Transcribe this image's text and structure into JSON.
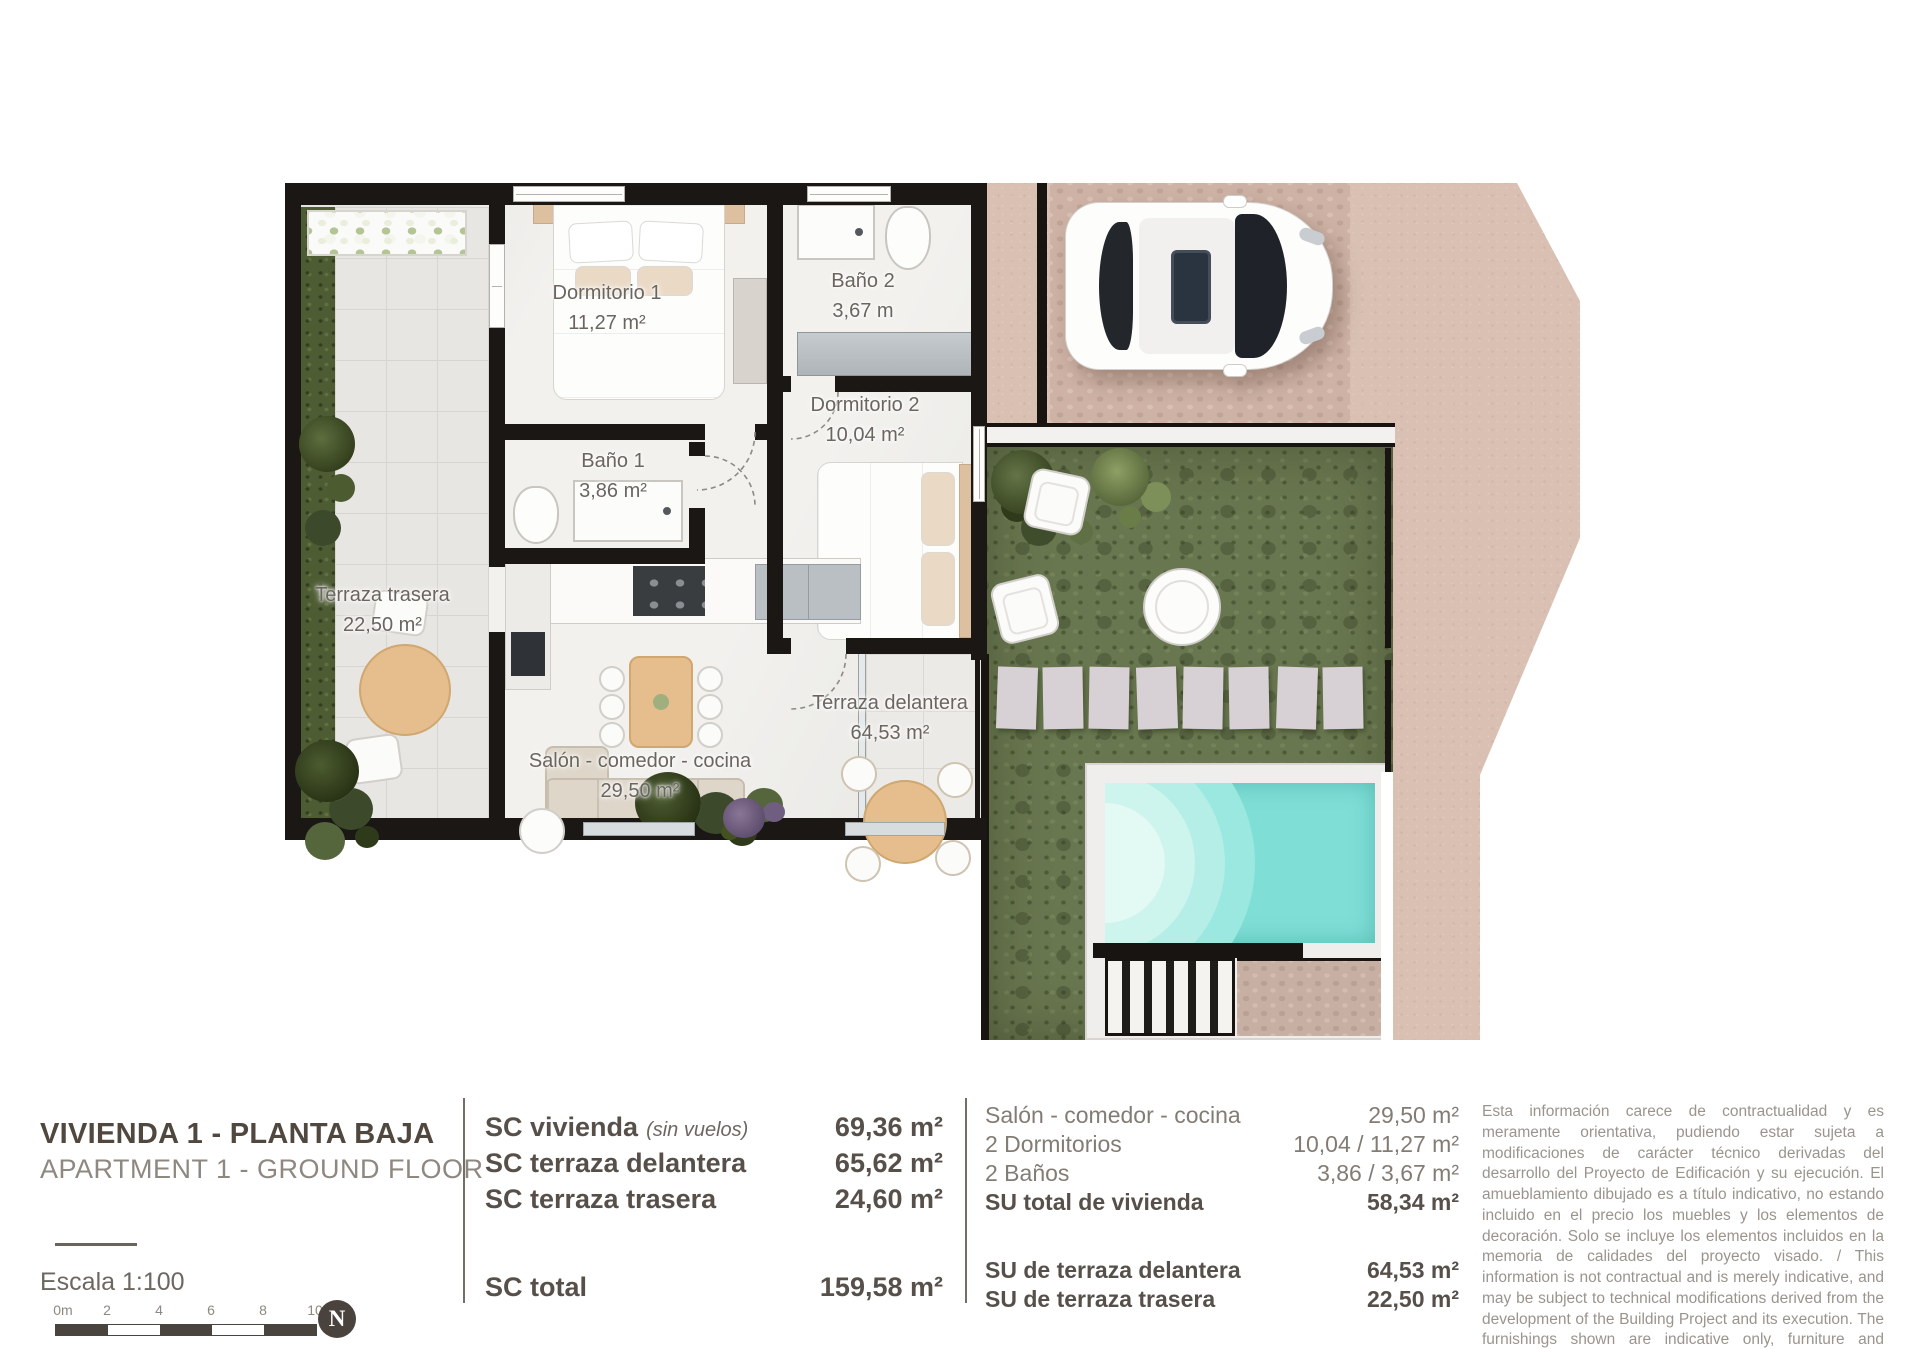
{
  "plan": {
    "rooms": [
      {
        "name": "Dormitorio 1",
        "area": "11,27 m²"
      },
      {
        "name": "Baño 2",
        "area": "3,67 m"
      },
      {
        "name": "Baño 1",
        "area": "3,86 m²"
      },
      {
        "name": "Dormitorio 2",
        "area": "10,04 m²"
      },
      {
        "name": "Terraza trasera",
        "area": "22,50 m²"
      },
      {
        "name": "Salón - comedor - cocina",
        "area": "29,50 m²"
      },
      {
        "name": "Terraza delantera",
        "area": "64,53 m²"
      }
    ],
    "colors": {
      "pool_water": "#7fdfd7",
      "lawn": "#697750",
      "paving": "#d9c0b3",
      "wall": "#1a1715"
    }
  },
  "info": {
    "title_es": "VIVIENDA 1 - PLANTA BAJA",
    "title_en": "APARTMENT 1 - GROUND FLOOR",
    "scale_label": "Escala  1:100",
    "scale_ticks": [
      "0m",
      "2",
      "4",
      "6",
      "8",
      "10"
    ],
    "north_label": "N",
    "sc": {
      "rows": [
        {
          "label": "SC vivienda",
          "note": "(sin vuelos)",
          "value": "69,36 m²"
        },
        {
          "label": "SC terraza delantera",
          "note": "",
          "value": "65,62 m²"
        },
        {
          "label": "SC terraza trasera",
          "note": "",
          "value": "24,60 m²"
        }
      ],
      "total_label": "SC total",
      "total_value": "159,58 m²"
    },
    "su": {
      "rows": [
        {
          "label": "Salón - comedor - cocina",
          "value": "29,50 m²"
        },
        {
          "label": "2 Dormitorios",
          "value": "10,04 / 11,27 m²"
        },
        {
          "label": "2 Baños",
          "value": "3,86 / 3,67 m²"
        },
        {
          "label": "SU total de vivienda",
          "value": "58,34 m²"
        },
        {
          "label": "SU de terraza delantera",
          "value": "64,53 m²"
        },
        {
          "label": "SU de terraza trasera",
          "value": "22,50 m²"
        }
      ]
    },
    "disclaimer": "Esta información carece de contractualidad y es meramente orientativa, pudiendo estar sujeta a modificaciones de carácter técnico derivadas del desarrollo del Proyecto de Edificación y su ejecución. El amueblamiento dibujado es a título indicativo, no estando incluido en el precio los muebles y los elementos de decoración. Solo se incluye los elementos incluidos en la memoria de calidades del proyecto visado. / This information is not contractual and is merely indicative, and may be subject to technical modifications derived from the development of the Building Project and its execution. The furnishings shown are indicative only, furniture and decorative elements are not included in the price. Only the elements included in the quality specifications of the approved project are included."
  }
}
